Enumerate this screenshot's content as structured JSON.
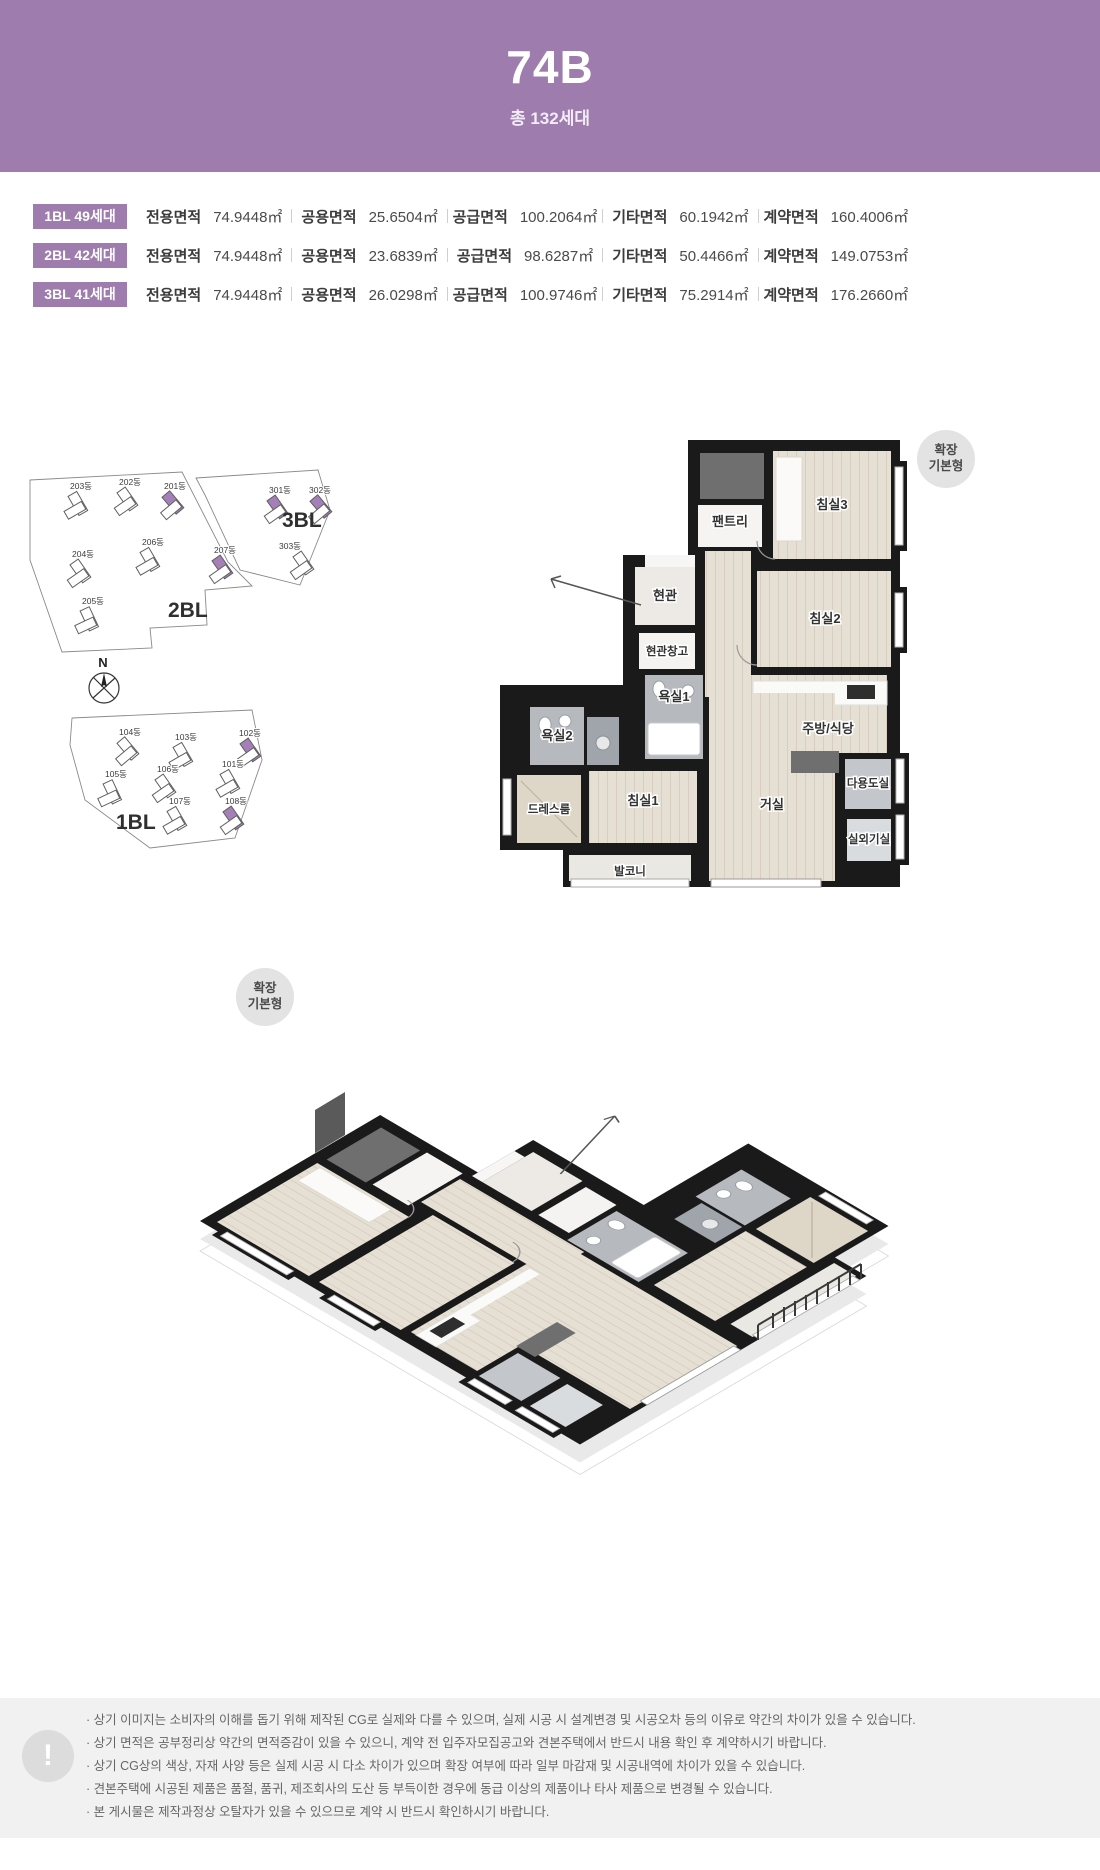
{
  "header": {
    "title": "74B",
    "subtitle": "총 132세대"
  },
  "colors": {
    "accent": "#9e7cae",
    "highlight": "#a580b8",
    "wall": "#1a1a1a",
    "wood": "#e6dfd3",
    "footer_bg": "#f1f1f1"
  },
  "area_table": {
    "rows": [
      {
        "badge": "1BL 49세대",
        "cells": [
          {
            "label": "전용면적",
            "value": "74.9448㎡"
          },
          {
            "label": "공용면적",
            "value": "25.6504㎡"
          },
          {
            "label": "공급면적",
            "value": "100.2064㎡"
          },
          {
            "label": "기타면적",
            "value": "60.1942㎡"
          },
          {
            "label": "계약면적",
            "value": "160.4006㎡"
          }
        ]
      },
      {
        "badge": "2BL 42세대",
        "cells": [
          {
            "label": "전용면적",
            "value": "74.9448㎡"
          },
          {
            "label": "공용면적",
            "value": "23.6839㎡"
          },
          {
            "label": "공급면적",
            "value": "98.6287㎡"
          },
          {
            "label": "기타면적",
            "value": "50.4466㎡"
          },
          {
            "label": "계약면적",
            "value": "149.0753㎡"
          }
        ]
      },
      {
        "badge": "3BL 41세대",
        "cells": [
          {
            "label": "전용면적",
            "value": "74.9448㎡"
          },
          {
            "label": "공용면적",
            "value": "26.0298㎡"
          },
          {
            "label": "공급면적",
            "value": "100.9746㎡"
          },
          {
            "label": "기타면적",
            "value": "75.2914㎡"
          },
          {
            "label": "계약면적",
            "value": "176.2660㎡"
          }
        ]
      }
    ]
  },
  "site_plan": {
    "compass": "N",
    "blocks": [
      {
        "label": "2BL"
      },
      {
        "label": "3BL"
      },
      {
        "label": "1BL"
      }
    ],
    "buildings": [
      {
        "label": "203동"
      },
      {
        "label": "202동"
      },
      {
        "label": "201동"
      },
      {
        "label": "204동"
      },
      {
        "label": "206동"
      },
      {
        "label": "207동"
      },
      {
        "label": "205동"
      },
      {
        "label": "301동"
      },
      {
        "label": "302동"
      },
      {
        "label": "303동"
      },
      {
        "label": "104동"
      },
      {
        "label": "103동"
      },
      {
        "label": "102동"
      },
      {
        "label": "105동"
      },
      {
        "label": "106동"
      },
      {
        "label": "101동"
      },
      {
        "label": "107동"
      },
      {
        "label": "108동"
      }
    ]
  },
  "floor_plan": {
    "badge_line1": "확장",
    "badge_line2": "기본형",
    "rooms": {
      "pantry": "팬트리",
      "bed3": "침실3",
      "entry": "현관",
      "entry_storage": "현관창고",
      "bed2": "침실2",
      "bath1": "욕실1",
      "bath2": "욕실2",
      "kitchen": "주방/식당",
      "utility": "다용도실",
      "dress": "드레스룸",
      "bed1": "침실1",
      "living": "거실",
      "ac": "실외기실",
      "balcony": "발코니"
    }
  },
  "iso_plan": {
    "badge_line1": "확장",
    "badge_line2": "기본형"
  },
  "footer": {
    "icon": "!",
    "notes": [
      "· 상기 이미지는 소비자의 이해를 돕기 위해 제작된 CG로 실제와 다를 수 있으며, 실제 시공 시 설계변경 및 시공오차 등의 이유로 약간의 차이가 있을 수 있습니다.",
      "· 상기 면적은 공부정리상 약간의 면적증감이 있을 수 있으니, 계약 전 입주자모집공고와 견본주택에서 반드시 내용 확인 후 계약하시기 바랍니다.",
      "· 상기 CG상의 색상, 자재 사양 등은 실제 시공 시 다소 차이가 있으며 확장 여부에 따라 일부 마감재 및 시공내역에 차이가 있을 수 있습니다.",
      "· 견본주택에 시공된 제품은 품절, 품귀, 제조회사의 도산 등 부득이한 경우에 동급 이상의 제품이나 타사 제품으로 변경될 수 있습니다.",
      "· 본 게시물은 제작과정상 오탈자가 있을 수 있으므로 계약 시 반드시 확인하시기 바랍니다."
    ]
  }
}
